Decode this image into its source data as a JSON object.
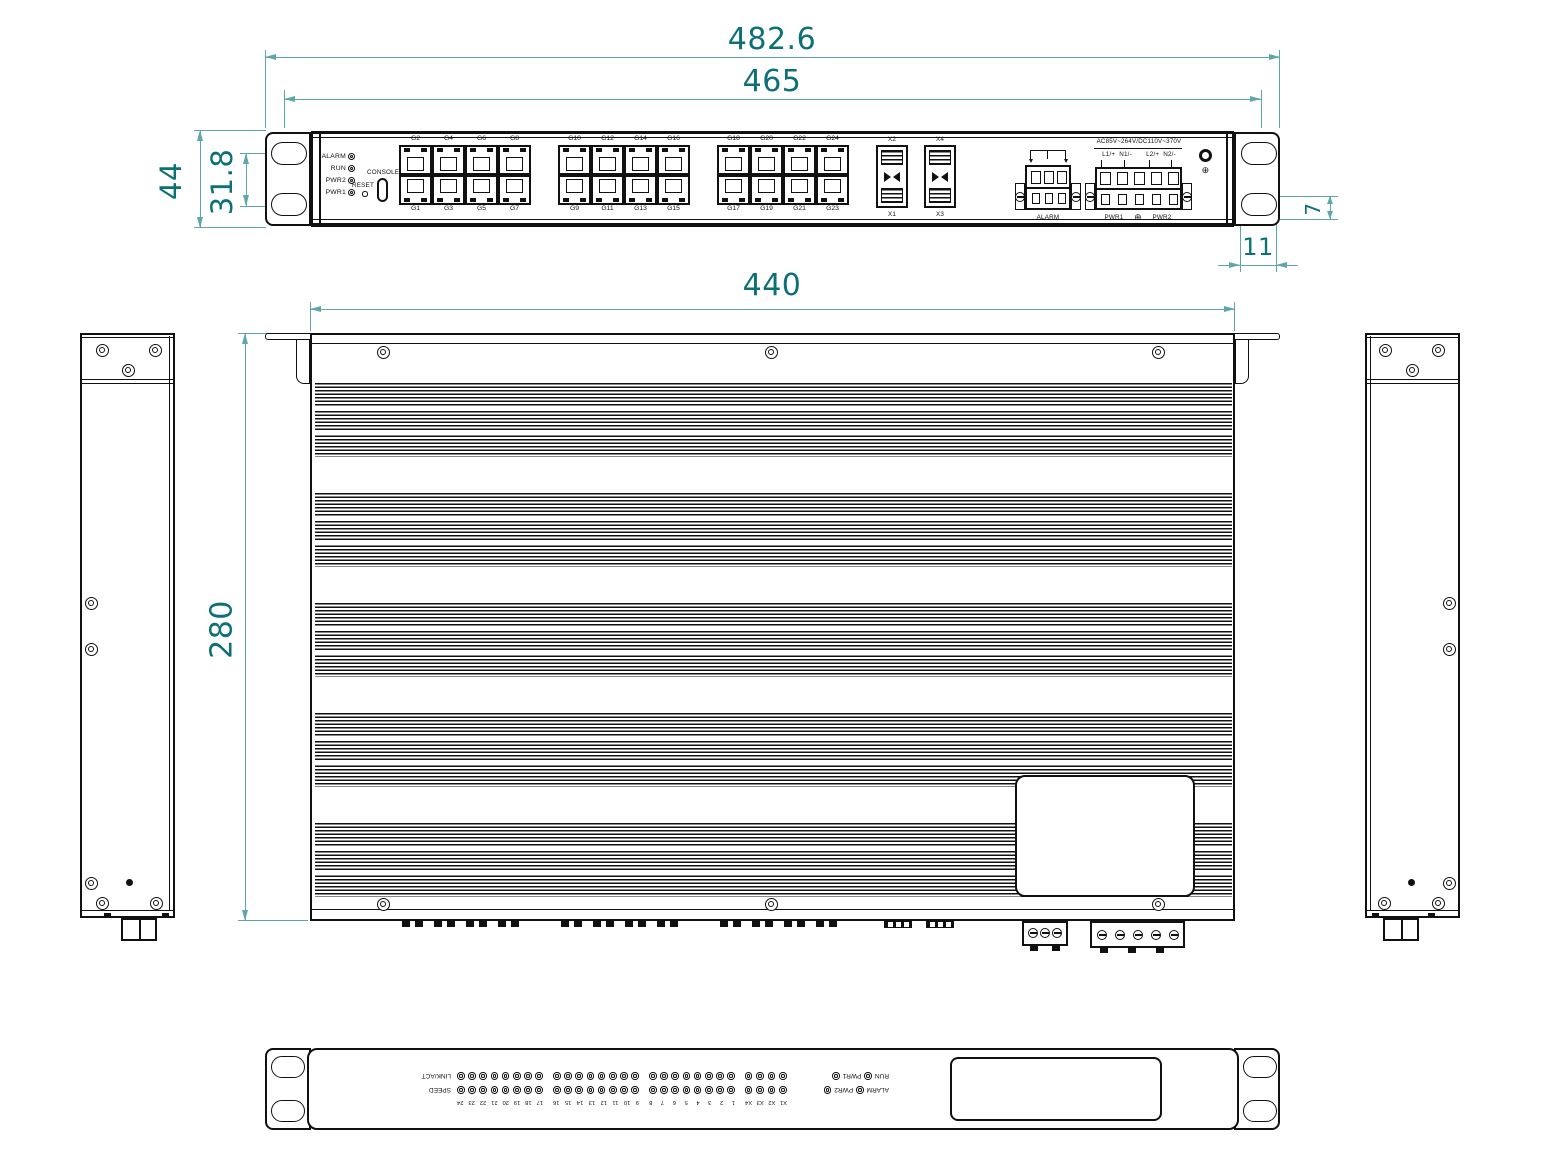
{
  "dimensions": {
    "overall_width": "482.6",
    "mount_hole_span": "465",
    "front_height": "44",
    "ear_hole_pitch": "31.8",
    "ear_hole_height": "7",
    "ear_hole_width": "11",
    "chassis_width": "440",
    "chassis_depth": "280"
  },
  "front_panel": {
    "led_labels": [
      "ALARM",
      "RUN",
      "PWR2",
      "PWR1"
    ],
    "reset_label": "RESET",
    "console_label": "CONSOLE",
    "banks": [
      {
        "top": [
          "G2",
          "G4",
          "G6",
          "G8"
        ],
        "bottom": [
          "G1",
          "G3",
          "G5",
          "G7"
        ]
      },
      {
        "top": [
          "G10",
          "G12",
          "G14",
          "G16"
        ],
        "bottom": [
          "G9",
          "G11",
          "G13",
          "G15"
        ]
      },
      {
        "top": [
          "G18",
          "G20",
          "G22",
          "G24"
        ],
        "bottom": [
          "G17",
          "G19",
          "G21",
          "G23"
        ]
      }
    ],
    "sfp_top": [
      "X2",
      "X4"
    ],
    "sfp_bottom": [
      "X1",
      "X3"
    ],
    "alarm_terminal_label": "ALARM",
    "power": {
      "rating": "AC85V~264V/DC110V~370V",
      "input1": "L1/+  N1/-",
      "input2": "L2/+  N2/-",
      "pwr1_label": "PWR1",
      "pwr2_label": "PWR2",
      "ground_symbol": "⊕"
    }
  },
  "rear_panel": {
    "number_groups": [
      "X1 X2 X3 X4",
      "1 2 3 4 5 6 7 8",
      "9 10 11 12 13 14 15 16",
      "17 18 19 20 21 22 23 24"
    ],
    "speed_row": {
      "led_a": "ALARM",
      "led_b": "PWR2",
      "row_label": "SPEED"
    },
    "link_row": {
      "led_a": "RUN",
      "led_b": "PWR1",
      "row_label": "LINK/ACT"
    }
  }
}
